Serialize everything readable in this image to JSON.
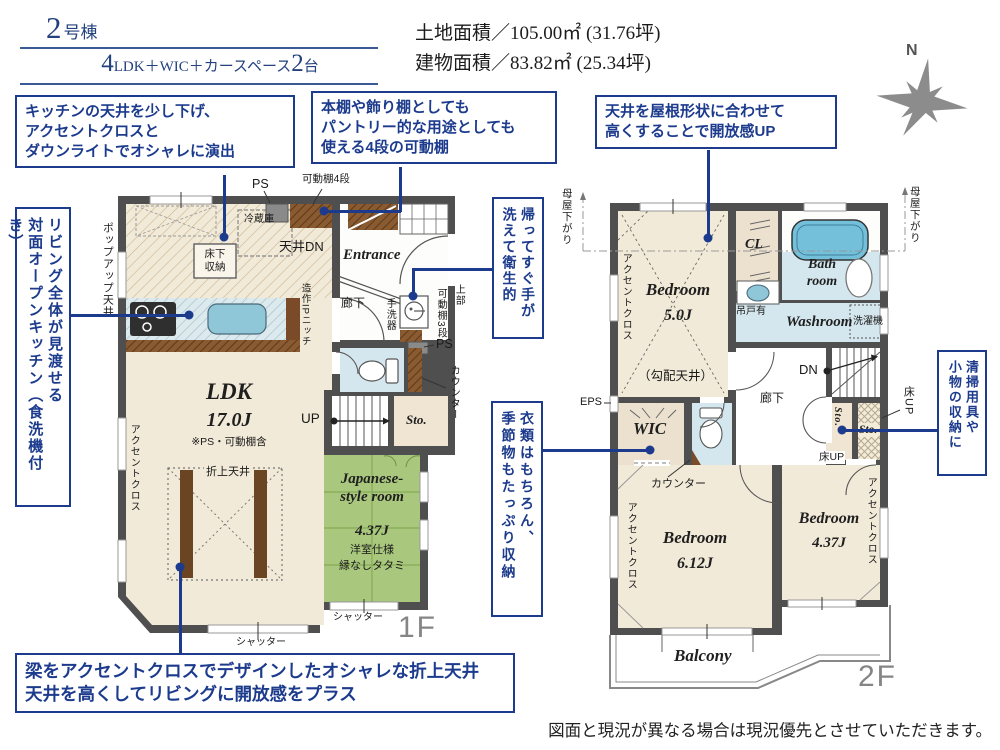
{
  "header": {
    "unit_num": "2",
    "unit_suffix": "号棟",
    "plan_num": "4",
    "plan_mid": "LDK＋WIC＋カースペース",
    "plan_cars": "2",
    "plan_end": "台",
    "land_area": "土地面積／105.00㎡ (31.76坪)",
    "building_area": "建物面積／83.82㎡ (25.34坪)"
  },
  "compass": {
    "north": "N"
  },
  "callouts": {
    "c1": "キッチンの天井を少し下げ、\nアクセントクロスと\nダウンライトでオシャレに演出",
    "c2": "本棚や飾り棚としても\nパントリー的な用途としても\n使える4段の可動棚",
    "c3": "天井を屋根形状に合わせて\n高くすることで開放感UP",
    "c4": "リビング全体が見渡せる\n対面オープンキッチン（食洗機付き）",
    "c5": "帰ってすぐ手が\n洗えて衛生的",
    "c6": "衣類はもちろん、\n季節物もたっぷり収納",
    "c7": "清掃用具や\n小物の収納に",
    "c8": "梁をアクセントクロスでデザインしたオシャレな折上天井\n天井を高くしてリビングに開放感をプラス"
  },
  "f1": {
    "big": "1F",
    "popup": "ポップアップ天井",
    "ps_top": "PS",
    "shelf4": "可動棚4段",
    "fridge": "冷蔵庫",
    "yukashita": "床下\n収納",
    "tenjo_dn": "天井DN",
    "entrance": "Entrance",
    "roka": "廊下",
    "tearai": "手洗器",
    "jobu": "上部",
    "shelf3": "可動棚3段",
    "ps_mid": "PS",
    "counter": "カウンター",
    "niche": "造作IPニッチ",
    "accent": "アクセントクロス",
    "ldk": "LDK",
    "ldk_j": "17.0J",
    "ldk_note": "※PS・可動棚含",
    "oriage": "折上天井",
    "up": "UP",
    "sto": "Sto.",
    "jp_name": "Japanese-\nstyle room",
    "jp_j": "4.37J",
    "jp_note1": "洋室仕様",
    "jp_note2": "縁なしタタミ",
    "shutter_a": "シャッター",
    "shutter_b": "シャッター"
  },
  "f2": {
    "big": "2F",
    "moya_l": "母屋下がり",
    "moya_r": "母屋下がり",
    "bed5": "Bedroom",
    "bed5_j": "5.0J",
    "kobai": "（勾配天井）",
    "accent5": "アクセントクロス",
    "cl": "CL",
    "bath": "Bath\nroom",
    "tsurido": "吊戸有",
    "washroom": "Washroom",
    "sentakki": "洗濯機",
    "eps": "EPS",
    "wic": "WIC",
    "counter": "カウンター",
    "roka": "廊下",
    "dn": "DN",
    "sto_v": "Sto.",
    "sto_h": "Sto.",
    "yuka_up_r": "床UP",
    "yuka_up_b": "床UP",
    "bed6": "Bedroom",
    "bed6_j": "6.12J",
    "accent6": "アクセントクロス",
    "bed4": "Bedroom",
    "bed4_j": "4.37J",
    "accent4": "アクセントクロス",
    "balcony": "Balcony"
  },
  "footer": {
    "disclaimer": "図面と現況が異なる場合は現況優先とさせていただきます。"
  }
}
